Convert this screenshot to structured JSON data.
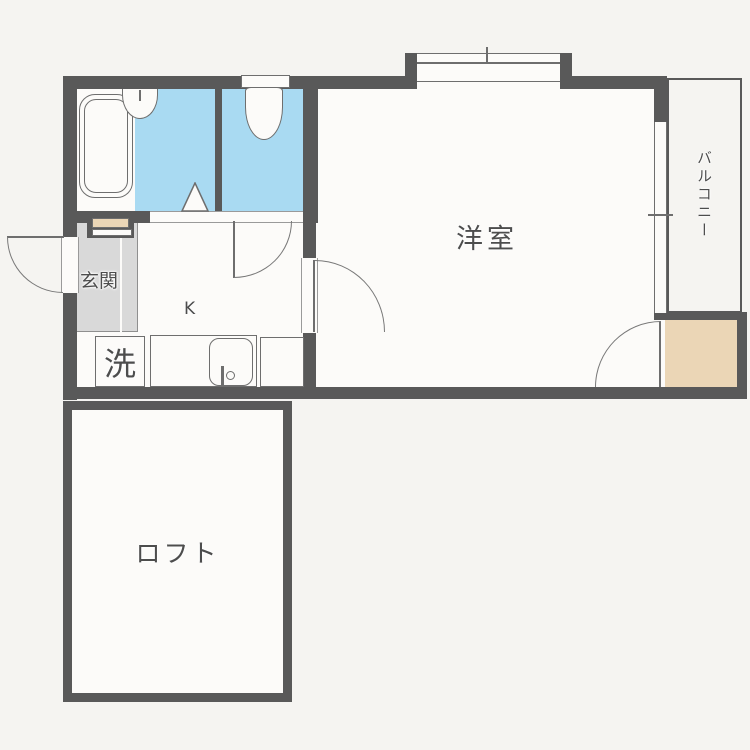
{
  "plan_type": "floor-plan",
  "rooms": {
    "western": {
      "label": "洋室"
    },
    "balcony": {
      "label": "バルコニー"
    },
    "entrance": {
      "label": "玄関"
    },
    "kitchen": {
      "label": "K"
    },
    "loft": {
      "label": "ロフト"
    },
    "laundry": {
      "label": "洗"
    }
  },
  "fixtures": {
    "bathtub": "bathtub",
    "washbasin": "washbasin",
    "toilet": "toilet",
    "kitchen_sink": "kitchen-sink",
    "stove_space": "stove-space",
    "shoe_cabinet": "shoe-cabinet",
    "closet": "closet"
  },
  "colors": {
    "wall": "#595959",
    "wet_area_floor": "#a9daf2",
    "entrance_floor": "#d9d9d9",
    "closet_floor": "#ebd6b6",
    "background": "#f5f4f1",
    "outline": "#6e6e6e"
  }
}
